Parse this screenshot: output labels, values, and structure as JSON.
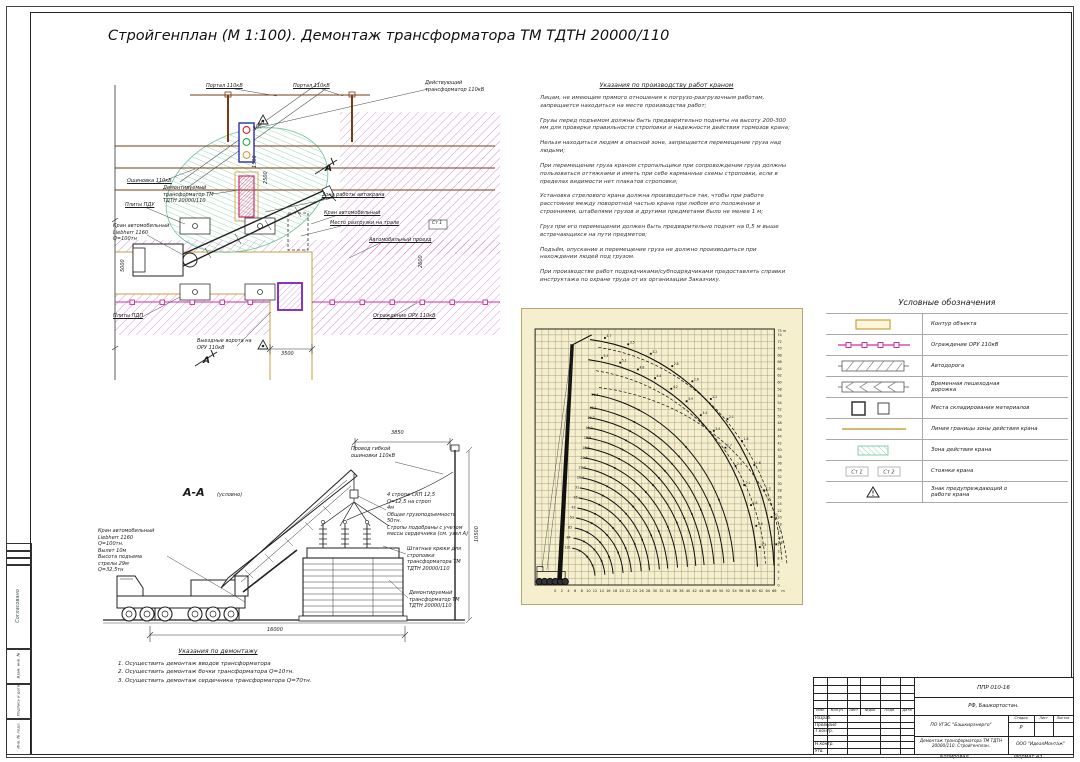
{
  "page": {
    "title": "Стройгенплан (М 1:100). Демонтаж трансформатора  ТМ  ТДТН 20000/110",
    "copied_label": "Копировал",
    "format_label": "Формат А3"
  },
  "side_strip": {
    "soglasovano": "Согласовано",
    "vzam": "Взам. инв. №",
    "podpis": "Подпись и дата",
    "inv": "Инв. № подл."
  },
  "plan": {
    "labels": {
      "portal": "Портал 110кВ",
      "acting_transformer": "Действующий\nтрансформатор 110кВ",
      "oshinovka": "Ошиновка 110кВ",
      "demounted_transformer": "Демонтируемый\nтрансформатор ТМ\nТДТН 20000/110",
      "plates_top": "Плиты ПДУ",
      "crane": "Кран автомобильный\nLiebherr 1160\nQ=100тн",
      "work_zone": "Зона работы автокрана",
      "crane_dashed": "Кран автомобильный",
      "unload_place": "Место разгрузки на трале",
      "road": "Автомобильный проезд",
      "plates_bottom": "Плиты ПДП",
      "gates": "Выездные ворота на\nОРУ 110кВ",
      "fence": "Ограждение ОРУ 110кВ",
      "stand1": "Ст 1",
      "section_mark": "А"
    },
    "dims": {
      "d3000": "3000",
      "d1500": "1500",
      "d2500": "2500",
      "d3500": "3500",
      "d5000": "5000",
      "d2600": "2600"
    }
  },
  "section": {
    "title": "А-А",
    "subtitle": "(условно)",
    "labels": {
      "crane_spec": "Кран автомобильный\nLiebherr 1160\nQ=100тн.\nВылет 10м\nВысота подъема\nстрелы 29м\nQ=32,5тн",
      "wire": "Провод гибкой\nошиновки 110кВ",
      "slings": "4 стропа СКП 12,5\nQ=12,5 на строп\n4м\nОбщая грузоподъемность\n50тн.\nСтропы подобраны с учетом\nмассы сердечника (см. узел А)",
      "hooks": "Штатные крюки для\nстроповки\nтрансформатора ТМ\nТДТН 20000/110",
      "transformer": "Демонтируемый\nтрансформатор ТМ\nТДТН 20000/110"
    },
    "dims": {
      "d3850": "3850",
      "d10500": "10500",
      "d16000": "16000"
    }
  },
  "instructions": {
    "title": "Указания по производству работ краном",
    "paragraphs": [
      "Лицам, не имеющим прямого отношения к погрузо-разгрузочным работам, запрещается находиться на месте производства работ;",
      "Грузы перед подъемом должны быть предварительно подняты на высоту 200-300 мм для проверки правильности строповки и надежности действия тормозов крана;",
      "Нельзя находиться людям в опасной зоне, запрещается перемещение груза над людьми;",
      "При перемещении груза краном стропальщики при сопровождении груза должны пользоваться оттяжками и иметь при себе карманные схемы строповки, если в пределах видимости нет плакатов строповки;",
      "Установка стрелового крана должна производиться так, чтобы при работе расстояние между поворотной частью крана при любом его положении и строениями, штабелями грузов и другими предметами было не менее 1 м;",
      "Груз при его перемещении должен быть предварительно поднят на 0,5 м выше встречающихся на пути предметов;",
      "Подъём, опускание и перемещение груза не должно производиться при нахождении людей под грузом.",
      "При производстве работ подрядчиками/субподрядчиками предоставлять справки инструктажа по охране труда от их организации Заказчику."
    ]
  },
  "demontage_notes": {
    "title": "Указания по демонтажу",
    "items": [
      "1. Осуществить демонтаж вводов трансформатора",
      "2. Осуществить демонтаж бочки трансформатора Q=10тн.",
      "3. Осуществить демонтаж сердечника трансформатора Q=70тн."
    ]
  },
  "legend": {
    "title": "Условные обозначения",
    "items": [
      {
        "symbol": "contour",
        "label": "Контур объекта"
      },
      {
        "symbol": "fence",
        "label": "Ограждение ОРУ 110кВ"
      },
      {
        "symbol": "road",
        "label": "Автодорога"
      },
      {
        "symbol": "walkway",
        "label": "Временная пешеходная\nдорожка"
      },
      {
        "symbol": "storage",
        "label": "Места складирования материалов"
      },
      {
        "symbol": "boundary",
        "label": "Линия границы зоны действия крана"
      },
      {
        "symbol": "zone",
        "label": "Зона действия крана"
      },
      {
        "symbol": "stands",
        "label": "Стоянки крана",
        "extra": [
          "Ст 1",
          "Ст 2"
        ]
      },
      {
        "symbol": "warning",
        "label": "Знак предупреждающий о\nработе крана"
      }
    ]
  },
  "crane_chart": {
    "type": "line",
    "x_axis": {
      "min": 0,
      "max": 66,
      "step": 2,
      "unit": "m"
    },
    "y_axis": {
      "min": 0,
      "max": 75,
      "step": 2,
      "unit": "m"
    },
    "jib_arcs": [
      {
        "rx": 62,
        "ry": 71,
        "labels": [
          "3.7",
          "3.5",
          "3.2",
          "2.8",
          "2.6",
          "2.2",
          "2.1",
          "1.8",
          "1.6",
          "1.3",
          "1.1",
          "0.8"
        ]
      },
      {
        "rx": 57,
        "ry": 65,
        "labels": [
          "5.5",
          "5.1",
          "4.8",
          "4.4",
          "4.2",
          "3.9",
          "3.4",
          "3.0",
          "2.7",
          "2.4",
          "2.1",
          "1.8",
          "1.6",
          "1.3"
        ]
      }
    ],
    "main_arcs": [
      {
        "rx": 50,
        "ry": 55,
        "label": "11.4"
      },
      {
        "rx": 47,
        "ry": 51,
        "label": "12.1"
      },
      {
        "rx": 44,
        "ry": 48,
        "label": "13.2"
      },
      {
        "rx": 41,
        "ry": 45,
        "label": "14.2"
      },
      {
        "rx": 38.5,
        "ry": 42,
        "label": "15.8"
      },
      {
        "rx": 36,
        "ry": 39,
        "label": "18.5"
      },
      {
        "rx": 33,
        "ry": 36,
        "label": "20.5"
      },
      {
        "rx": 30,
        "ry": 33,
        "label": "22.7"
      },
      {
        "rx": 27.5,
        "ry": 30,
        "label": "26.1"
      },
      {
        "rx": 24.5,
        "ry": 27,
        "label": "31"
      },
      {
        "rx": 22,
        "ry": 24,
        "label": "36"
      },
      {
        "rx": 19,
        "ry": 21,
        "label": "42"
      },
      {
        "rx": 16.5,
        "ry": 18,
        "label": "51"
      },
      {
        "rx": 13.5,
        "ry": 15,
        "label": "65"
      },
      {
        "rx": 11,
        "ry": 12,
        "label": "84"
      },
      {
        "rx": 8,
        "ry": 9,
        "label": "101"
      }
    ],
    "dashed_arcs": [
      {
        "rx": 64.5,
        "ry": 69
      },
      {
        "rx": 59.5,
        "ry": 62
      },
      {
        "rx": 66,
        "ry": 57
      }
    ],
    "colors": {
      "background": "#f6efcd",
      "grid": "#8d8468",
      "curves": "#111111"
    }
  },
  "title_block": {
    "doc_number": "ППР 010-16",
    "location": "РФ, Башкортостан.",
    "columns": {
      "izm": "Изм.",
      "koluch": "Кол.уч",
      "list": "Лист",
      "ndok": "№док",
      "podp": "Подп.",
      "data": "Дата"
    },
    "roles": {
      "razrab": "Разраб.",
      "prover": "Проверил",
      "tkontr": "Т.контр.",
      "nkontr": "Н.контр.",
      "utv": "Утв."
    },
    "object": "ПО УГЭС \"Башкирэнерго\"",
    "stage_headers": {
      "stage": "Стадия",
      "sheet": "Лист",
      "sheets": "Листов"
    },
    "stage_value": "Р",
    "doc_title": "Демонтаж трансформатора ТМ ТДТН\n20000/110. Стройгенплан.",
    "company": "ООО \"ИдеалМонтаж\""
  },
  "colors": {
    "hatch_purple": "#c85ec8",
    "fence_magenta": "#d12ba0",
    "zone_green": "#6cc29a",
    "contour_yellow": "#c8a23c",
    "busbar_brown": "#7a3b12",
    "transformer_blue": "#2a2ab4",
    "demount_red": "#cf2f6b",
    "violet": "#7a1fbe",
    "chart_bg": "#f6efcd"
  }
}
